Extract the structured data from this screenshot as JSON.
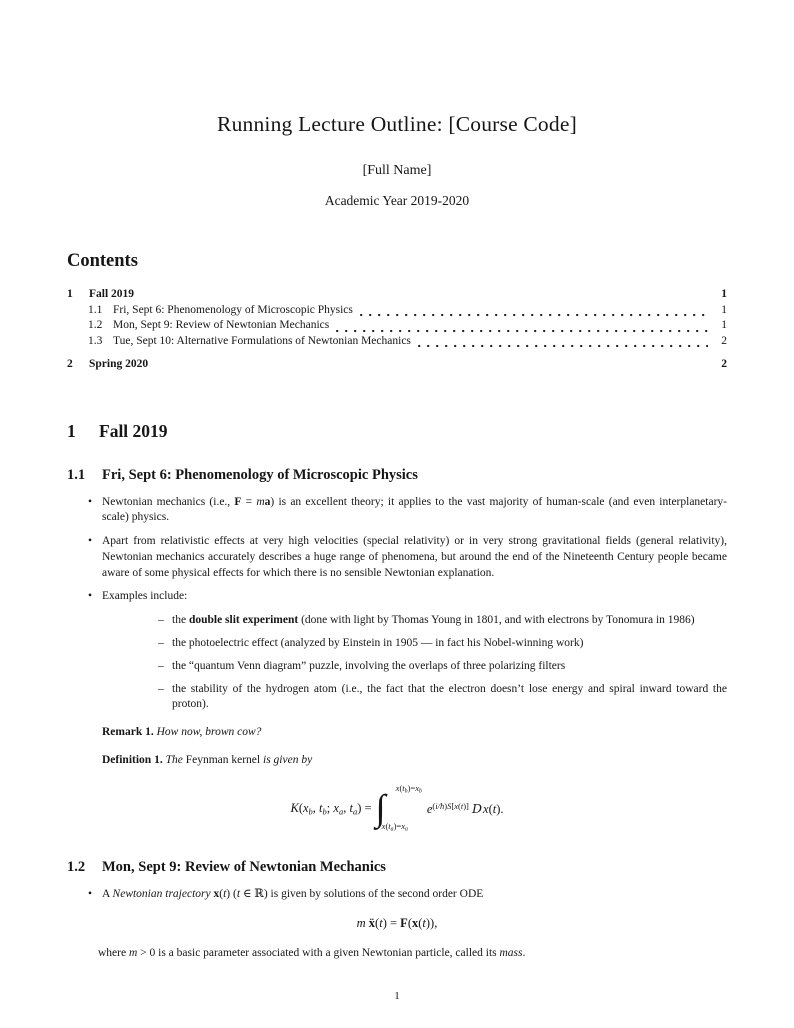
{
  "markers": {
    "bullet": "•",
    "dash": "–"
  },
  "header": {
    "title": "Running Lecture Outline: [Course Code]",
    "author": "[Full Name]",
    "date": "Academic Year 2019-2020"
  },
  "toc": {
    "heading": "Contents",
    "rows": [
      {
        "num": "1",
        "label": "Fall 2019",
        "page": "1"
      },
      {
        "num": "1.1",
        "label": "Fri, Sept 6: Phenomenology of Microscopic Physics",
        "page": "1"
      },
      {
        "num": "1.2",
        "label": "Mon, Sept 9: Review of Newtonian Mechanics",
        "page": "1"
      },
      {
        "num": "1.3",
        "label": "Tue, Sept 10: Alternative Formulations of Newtonian Mechanics",
        "page": "2"
      },
      {
        "num": "2",
        "label": "Spring 2020",
        "page": "2"
      }
    ]
  },
  "section1": {
    "num": "1",
    "title": "Fall 2019"
  },
  "sec11": {
    "num": "1.1",
    "title": "Fri, Sept 6: Phenomenology of Microscopic Physics",
    "bullet1": [
      {
        "t": "Newtonian mechanics (i.e., ",
        "s": ""
      },
      {
        "t": "F",
        "s": "b"
      },
      {
        "t": " = ",
        "s": ""
      },
      {
        "t": "m",
        "s": "i"
      },
      {
        "t": "a",
        "s": "b"
      },
      {
        "t": ") is an excellent theory; it applies to the vast majority of human-scale (and even interplanetary-scale) physics.",
        "s": ""
      }
    ],
    "bullet2": [
      {
        "t": "Apart from relativistic effects at very high velocities (special relativity) or in very strong gravitational fields (general relativity), Newtonian mechanics accurately describes a huge range of phenomena, but around the end of the Nineteenth Century people became aware of some physical effects for which there is no sensible Newtonian explanation.",
        "s": ""
      }
    ],
    "bullet3": [
      {
        "t": "Examples include:",
        "s": ""
      }
    ],
    "examples": [
      [
        {
          "t": "the ",
          "s": ""
        },
        {
          "t": "double slit experiment",
          "s": "b"
        },
        {
          "t": " (done with light by Thomas Young in 1801, and with electrons by Tonomura in 1986)",
          "s": ""
        }
      ],
      [
        {
          "t": "the photoelectric effect (analyzed by Einstein in 1905 — in fact his Nobel-winning work)",
          "s": ""
        }
      ],
      [
        {
          "t": "the “quantum Venn diagram” puzzle, involving the overlaps of three polarizing filters",
          "s": ""
        }
      ],
      [
        {
          "t": "the stability of the hydrogen atom (i.e., the fact that the electron doesn’t lose energy and spiral inward toward the proton).",
          "s": ""
        }
      ]
    ],
    "remark": [
      {
        "t": "Remark 1.",
        "s": "b"
      },
      {
        "t": " ",
        "s": ""
      },
      {
        "t": "How now, brown cow?",
        "s": "i"
      }
    ],
    "definition": [
      {
        "t": "Definition 1.",
        "s": "b"
      },
      {
        "t": " ",
        "s": ""
      },
      {
        "t": "The",
        "s": "i"
      },
      {
        "t": " Feynman kernel ",
        "s": ""
      },
      {
        "t": "is given by",
        "s": "i"
      }
    ],
    "eq_kernel": {
      "lhs": [
        {
          "t": "K",
          "s": "i"
        },
        {
          "t": "(",
          "s": ""
        },
        {
          "t": "x",
          "s": "i"
        },
        {
          "t": "b",
          "s": "sub"
        },
        {
          "t": ", ",
          "s": ""
        },
        {
          "t": "t",
          "s": "i"
        },
        {
          "t": "b",
          "s": "sub"
        },
        {
          "t": "; ",
          "s": ""
        },
        {
          "t": "x",
          "s": "i"
        },
        {
          "t": "a",
          "s": "sub"
        },
        {
          "t": ", ",
          "s": ""
        },
        {
          "t": "t",
          "s": "i"
        },
        {
          "t": "a",
          "s": "sub"
        },
        {
          "t": ") = ",
          "s": ""
        }
      ],
      "integral_sign": "∫",
      "upper": [
        {
          "t": "x",
          "s": "i"
        },
        {
          "t": "(",
          "s": ""
        },
        {
          "t": "t",
          "s": "i"
        },
        {
          "t": "b",
          "s": "sub"
        },
        {
          "t": ")=",
          "s": ""
        },
        {
          "t": "x",
          "s": "i"
        },
        {
          "t": "b",
          "s": "sub"
        }
      ],
      "lower": [
        {
          "t": "x",
          "s": "i"
        },
        {
          "t": "(",
          "s": ""
        },
        {
          "t": "t",
          "s": "i"
        },
        {
          "t": "a",
          "s": "sub"
        },
        {
          "t": ")=",
          "s": ""
        },
        {
          "t": "x",
          "s": "i"
        },
        {
          "t": "a",
          "s": "sub"
        }
      ],
      "integrand": [
        {
          "t": "e",
          "s": "i"
        },
        {
          "t": "(",
          "s": "sup"
        },
        {
          "t": "i/ħ",
          "s": "supi"
        },
        {
          "t": ")",
          "s": "sup"
        },
        {
          "t": "S",
          "s": "supi"
        },
        {
          "t": "[",
          "s": "sup"
        },
        {
          "t": "x",
          "s": "supi"
        },
        {
          "t": "(",
          "s": "sup"
        },
        {
          "t": "t",
          "s": "supi"
        },
        {
          "t": ")]",
          "s": "sup"
        },
        {
          "t": " ",
          "s": ""
        },
        {
          "t": "D",
          "s": "scr"
        },
        {
          "t": "x",
          "s": "i"
        },
        {
          "t": "(",
          "s": ""
        },
        {
          "t": "t",
          "s": "i"
        },
        {
          "t": ").",
          "s": ""
        }
      ]
    }
  },
  "sec12": {
    "num": "1.2",
    "title": "Mon, Sept 9: Review of Newtonian Mechanics",
    "bullet1": [
      {
        "t": "A ",
        "s": ""
      },
      {
        "t": "Newtonian trajectory",
        "s": "i"
      },
      {
        "t": " ",
        "s": ""
      },
      {
        "t": "x",
        "s": "b"
      },
      {
        "t": "(",
        "s": ""
      },
      {
        "t": "t",
        "s": "i"
      },
      {
        "t": ") (",
        "s": ""
      },
      {
        "t": "t",
        "s": "i"
      },
      {
        "t": " ∈ ℝ) is given by solutions of the second order ODE",
        "s": ""
      }
    ],
    "eq_newton": [
      {
        "t": "m",
        "s": "i"
      },
      {
        "t": " ",
        "s": ""
      },
      {
        "t": "ẍ",
        "s": "b"
      },
      {
        "t": "(",
        "s": ""
      },
      {
        "t": "t",
        "s": "i"
      },
      {
        "t": ") = ",
        "s": ""
      },
      {
        "t": "F",
        "s": "b"
      },
      {
        "t": "(",
        "s": ""
      },
      {
        "t": "x",
        "s": "b"
      },
      {
        "t": "(",
        "s": ""
      },
      {
        "t": "t",
        "s": "i"
      },
      {
        "t": ")),",
        "s": ""
      }
    ],
    "where_line": [
      {
        "t": "where ",
        "s": ""
      },
      {
        "t": "m",
        "s": "i"
      },
      {
        "t": " > 0 is a basic parameter associated with a given Newtonian particle, called its ",
        "s": ""
      },
      {
        "t": "mass",
        "s": "i"
      },
      {
        "t": ".",
        "s": ""
      }
    ]
  },
  "footer": {
    "page_number": "1"
  }
}
